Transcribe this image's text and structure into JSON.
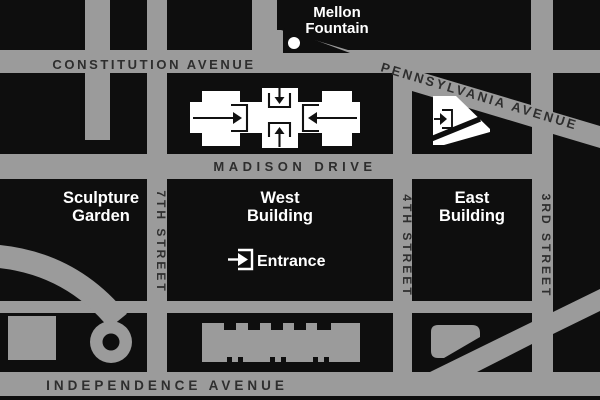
{
  "map": {
    "title": "National Gallery of Art area map",
    "streets": {
      "constitution": "CONSTITUTION AVENUE",
      "pennsylvania": "PENNSYLVANIA AVENUE",
      "madison": "MADISON DRIVE",
      "independence": "INDEPENDENCE AVENUE",
      "seventh": "7TH STREET",
      "fourth": "4TH STREET",
      "third": "3RD STREET"
    },
    "landmarks": {
      "mellon_line1": "Mellon",
      "mellon_line2": "Fountain",
      "sculpture_line1": "Sculpture",
      "sculpture_line2": "Garden",
      "west_line1": "West",
      "west_line2": "Building",
      "east_line1": "East",
      "east_line2": "Building",
      "entrance": "Entrance"
    },
    "icons": {
      "entrance_symbol": "arrow-into-bracket",
      "fountain_symbol": "white-dot"
    },
    "colors": {
      "street_gray": "#9b9b9b",
      "block_black": "#0e0e0e",
      "street_label": "#2e2e2e",
      "building_white": "#ffffff"
    }
  }
}
